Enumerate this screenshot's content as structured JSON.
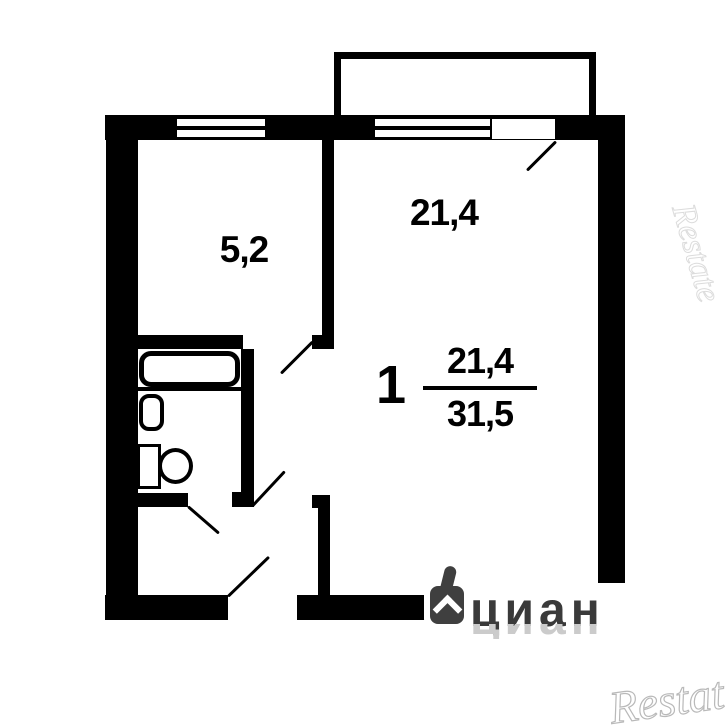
{
  "plan": {
    "kitchen": {
      "area": "5,2"
    },
    "living_room": {
      "area": "21,4"
    },
    "summary": {
      "rooms": "1",
      "living_area": "21,4",
      "total_area": "31,5"
    }
  },
  "watermarks": {
    "cian": "циан",
    "restate_top": "Restate",
    "restate_bottom": "Restate"
  },
  "colors": {
    "wall": "#000000",
    "background": "#ffffff",
    "cian_dark": "#3a3a3a",
    "cian_ghost": "#cbcbcb",
    "restate_stroke": "#b9b9b9"
  }
}
